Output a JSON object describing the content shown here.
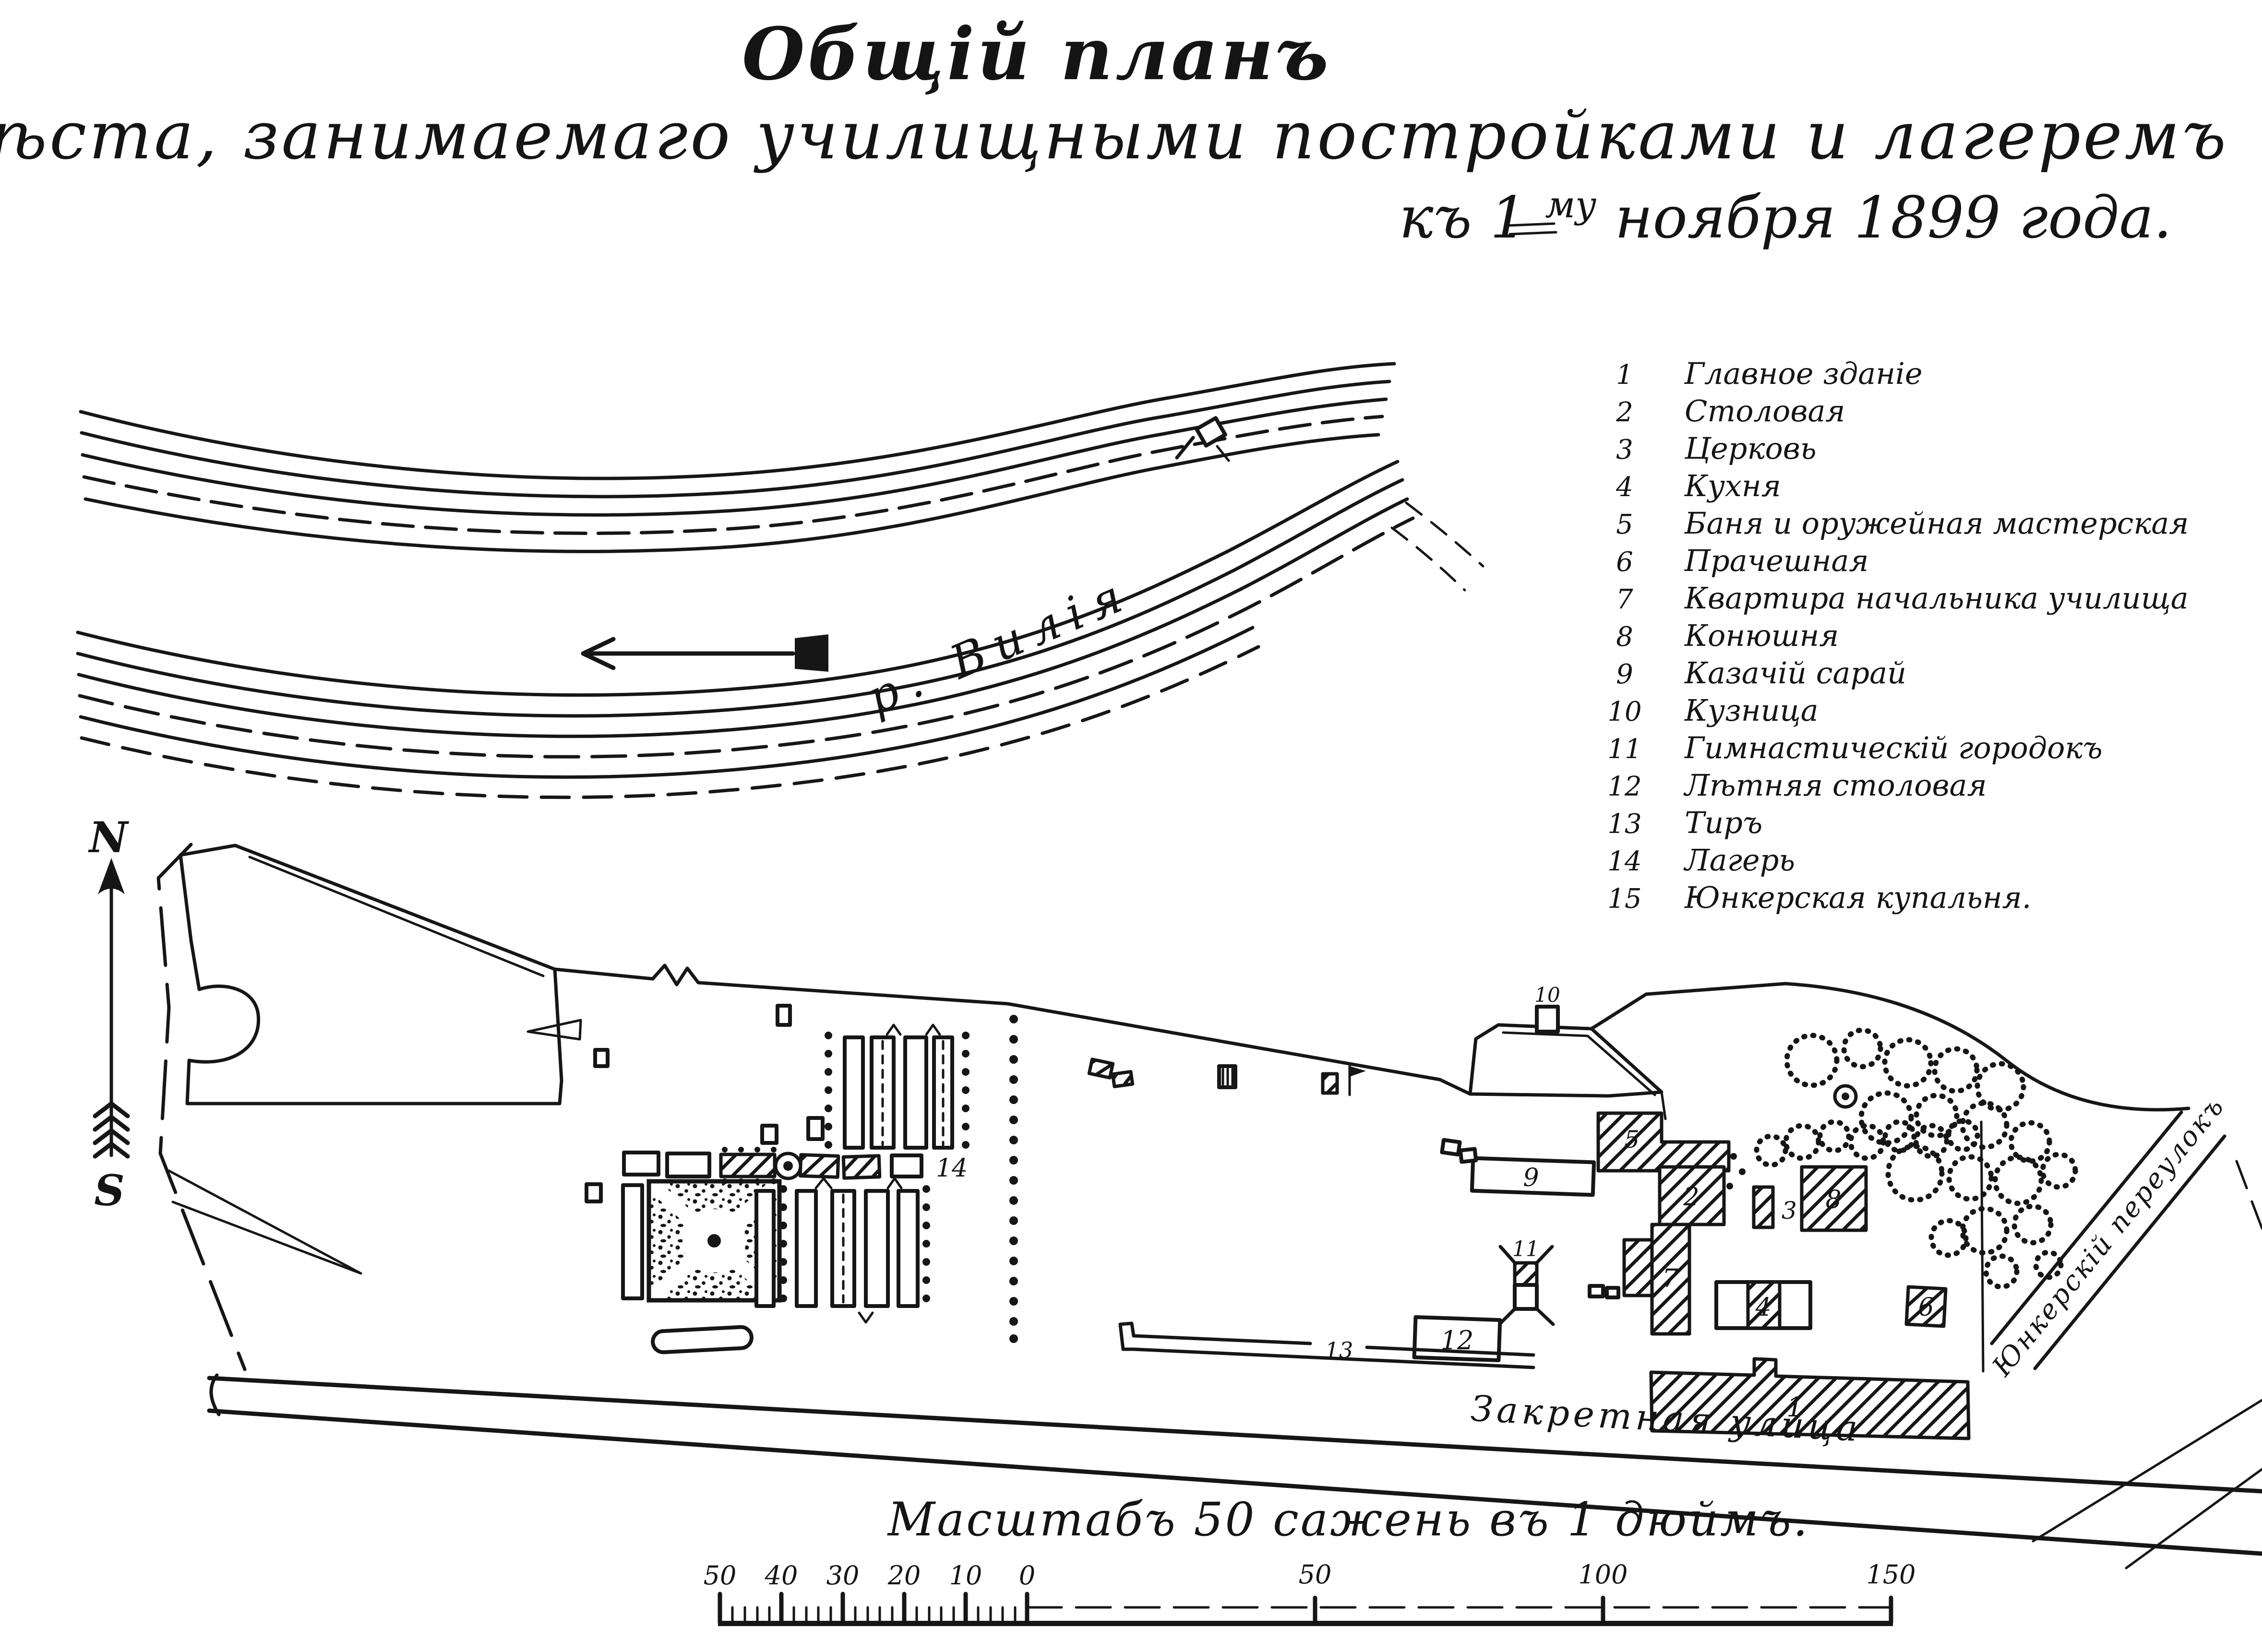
{
  "colors": {
    "ink": "#161616",
    "paper": "#ffffff"
  },
  "title": {
    "line1": "Общій планъ",
    "line2": "мѣста, занимаемаго училищными постройками и лагеремъ",
    "line3_part1": "къ 1",
    "line3_sup": "му",
    "line3_part2": " ноября 1899 года."
  },
  "legend": {
    "items": [
      {
        "num": "1",
        "label": "Главное зданіе"
      },
      {
        "num": "2",
        "label": "Столовая"
      },
      {
        "num": "3",
        "label": "Церковь"
      },
      {
        "num": "4",
        "label": "Кухня"
      },
      {
        "num": "5",
        "label": "Баня и оружейная мастерская"
      },
      {
        "num": "6",
        "label": "Прачешная"
      },
      {
        "num": "7",
        "label": "Квартира начальника училища"
      },
      {
        "num": "8",
        "label": "Конюшня"
      },
      {
        "num": "9",
        "label": "Казачій сарай"
      },
      {
        "num": "10",
        "label": "Кузница"
      },
      {
        "num": "11",
        "label": "Гимнастическій городокъ"
      },
      {
        "num": "12",
        "label": "Лѣтняя столовая"
      },
      {
        "num": "13",
        "label": "Тиръ"
      },
      {
        "num": "14",
        "label": "Лагерь"
      },
      {
        "num": "15",
        "label": "Юнкерская купальня."
      }
    ]
  },
  "river": {
    "label": "р. Вилія"
  },
  "compass": {
    "north": "N",
    "south": "S"
  },
  "streets": {
    "bottom": "Закретная улица",
    "lane": "Юнкерскій переулокъ"
  },
  "scale": {
    "caption": "Масштабъ 50 сажень въ 1 дюймъ.",
    "left_labels": [
      "50",
      "40",
      "30",
      "20",
      "10",
      "0"
    ],
    "right_labels": [
      "50",
      "100",
      "150"
    ]
  },
  "map_numbers": {
    "n1": "1",
    "n2": "2",
    "n3": "3",
    "n4": "4",
    "n5": "5",
    "n6": "6",
    "n7": "7",
    "n8": "8",
    "n9": "9",
    "n10": "10",
    "n11": "11",
    "n12": "12",
    "n13": "13",
    "n14": "14"
  }
}
